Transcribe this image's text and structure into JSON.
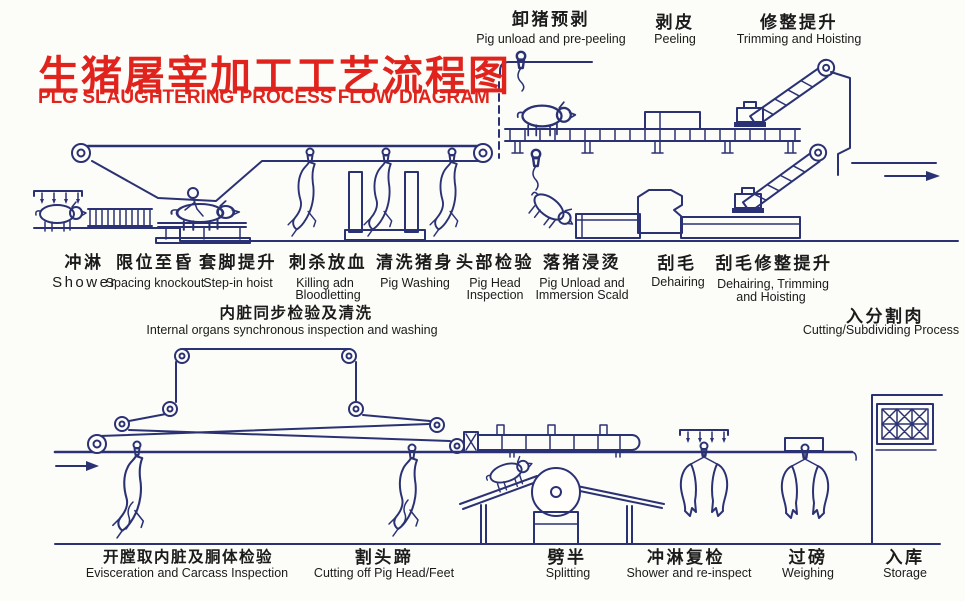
{
  "title": {
    "cn": "生猪屠宰加工工艺流程图",
    "en": "PLG SLAUGHTERING PROCESS FLOW DIAGRAM"
  },
  "colors": {
    "title_red": "#e0241d",
    "ink_blue": "#2b3274",
    "label_black": "#1b1b1b",
    "paper": "#fcfcf8"
  },
  "stations": {
    "top": [
      {
        "cn": "卸猪预剥",
        "en": "Pig unload and pre-peeling"
      },
      {
        "cn": "剥皮",
        "en": "Peeling"
      },
      {
        "cn": "修整提升",
        "en": "Trimming and Hoisting"
      }
    ],
    "middle": [
      {
        "cn": "冲淋",
        "en": "Shower"
      },
      {
        "cn": "限位至昏",
        "en": "Spacing knockout"
      },
      {
        "cn": "套脚提升",
        "en": "Step-in hoist"
      },
      {
        "cn": "刺杀放血",
        "en": "Killing adn",
        "en2": "Bloodletting"
      },
      {
        "cn": "清洗猪身",
        "en": "Pig Washing"
      },
      {
        "cn": "头部检验",
        "en": "Pig  Head",
        "en2": "Inspection"
      },
      {
        "cn": "落猪浸烫",
        "en": "Pig  Unload and",
        "en2": "Immersion Scald"
      },
      {
        "cn": "刮毛",
        "en": "Dehairing"
      },
      {
        "cn": "刮毛修整提升",
        "en": "Dehairing, Trimming",
        "en2": "and Hoisting"
      }
    ],
    "internal": {
      "cn": "内脏同步检验及清洗",
      "en": "Internal organs synchronous inspection and washing"
    },
    "cutting": {
      "cn": "入分割肉",
      "en": "Cutting/Subdividing Process"
    },
    "bottom": [
      {
        "cn": "开膛取内脏及胴体检验",
        "en": "Evisceration and Carcass Inspection"
      },
      {
        "cn": "割头蹄",
        "en": "Cutting off Pig Head/Feet"
      },
      {
        "cn": "劈半",
        "en": "Splitting"
      },
      {
        "cn": "冲淋复检",
        "en": "Shower and re-inspect"
      },
      {
        "cn": "过磅",
        "en": "Weighing"
      },
      {
        "cn": "入库",
        "en": "Storage"
      }
    ]
  }
}
